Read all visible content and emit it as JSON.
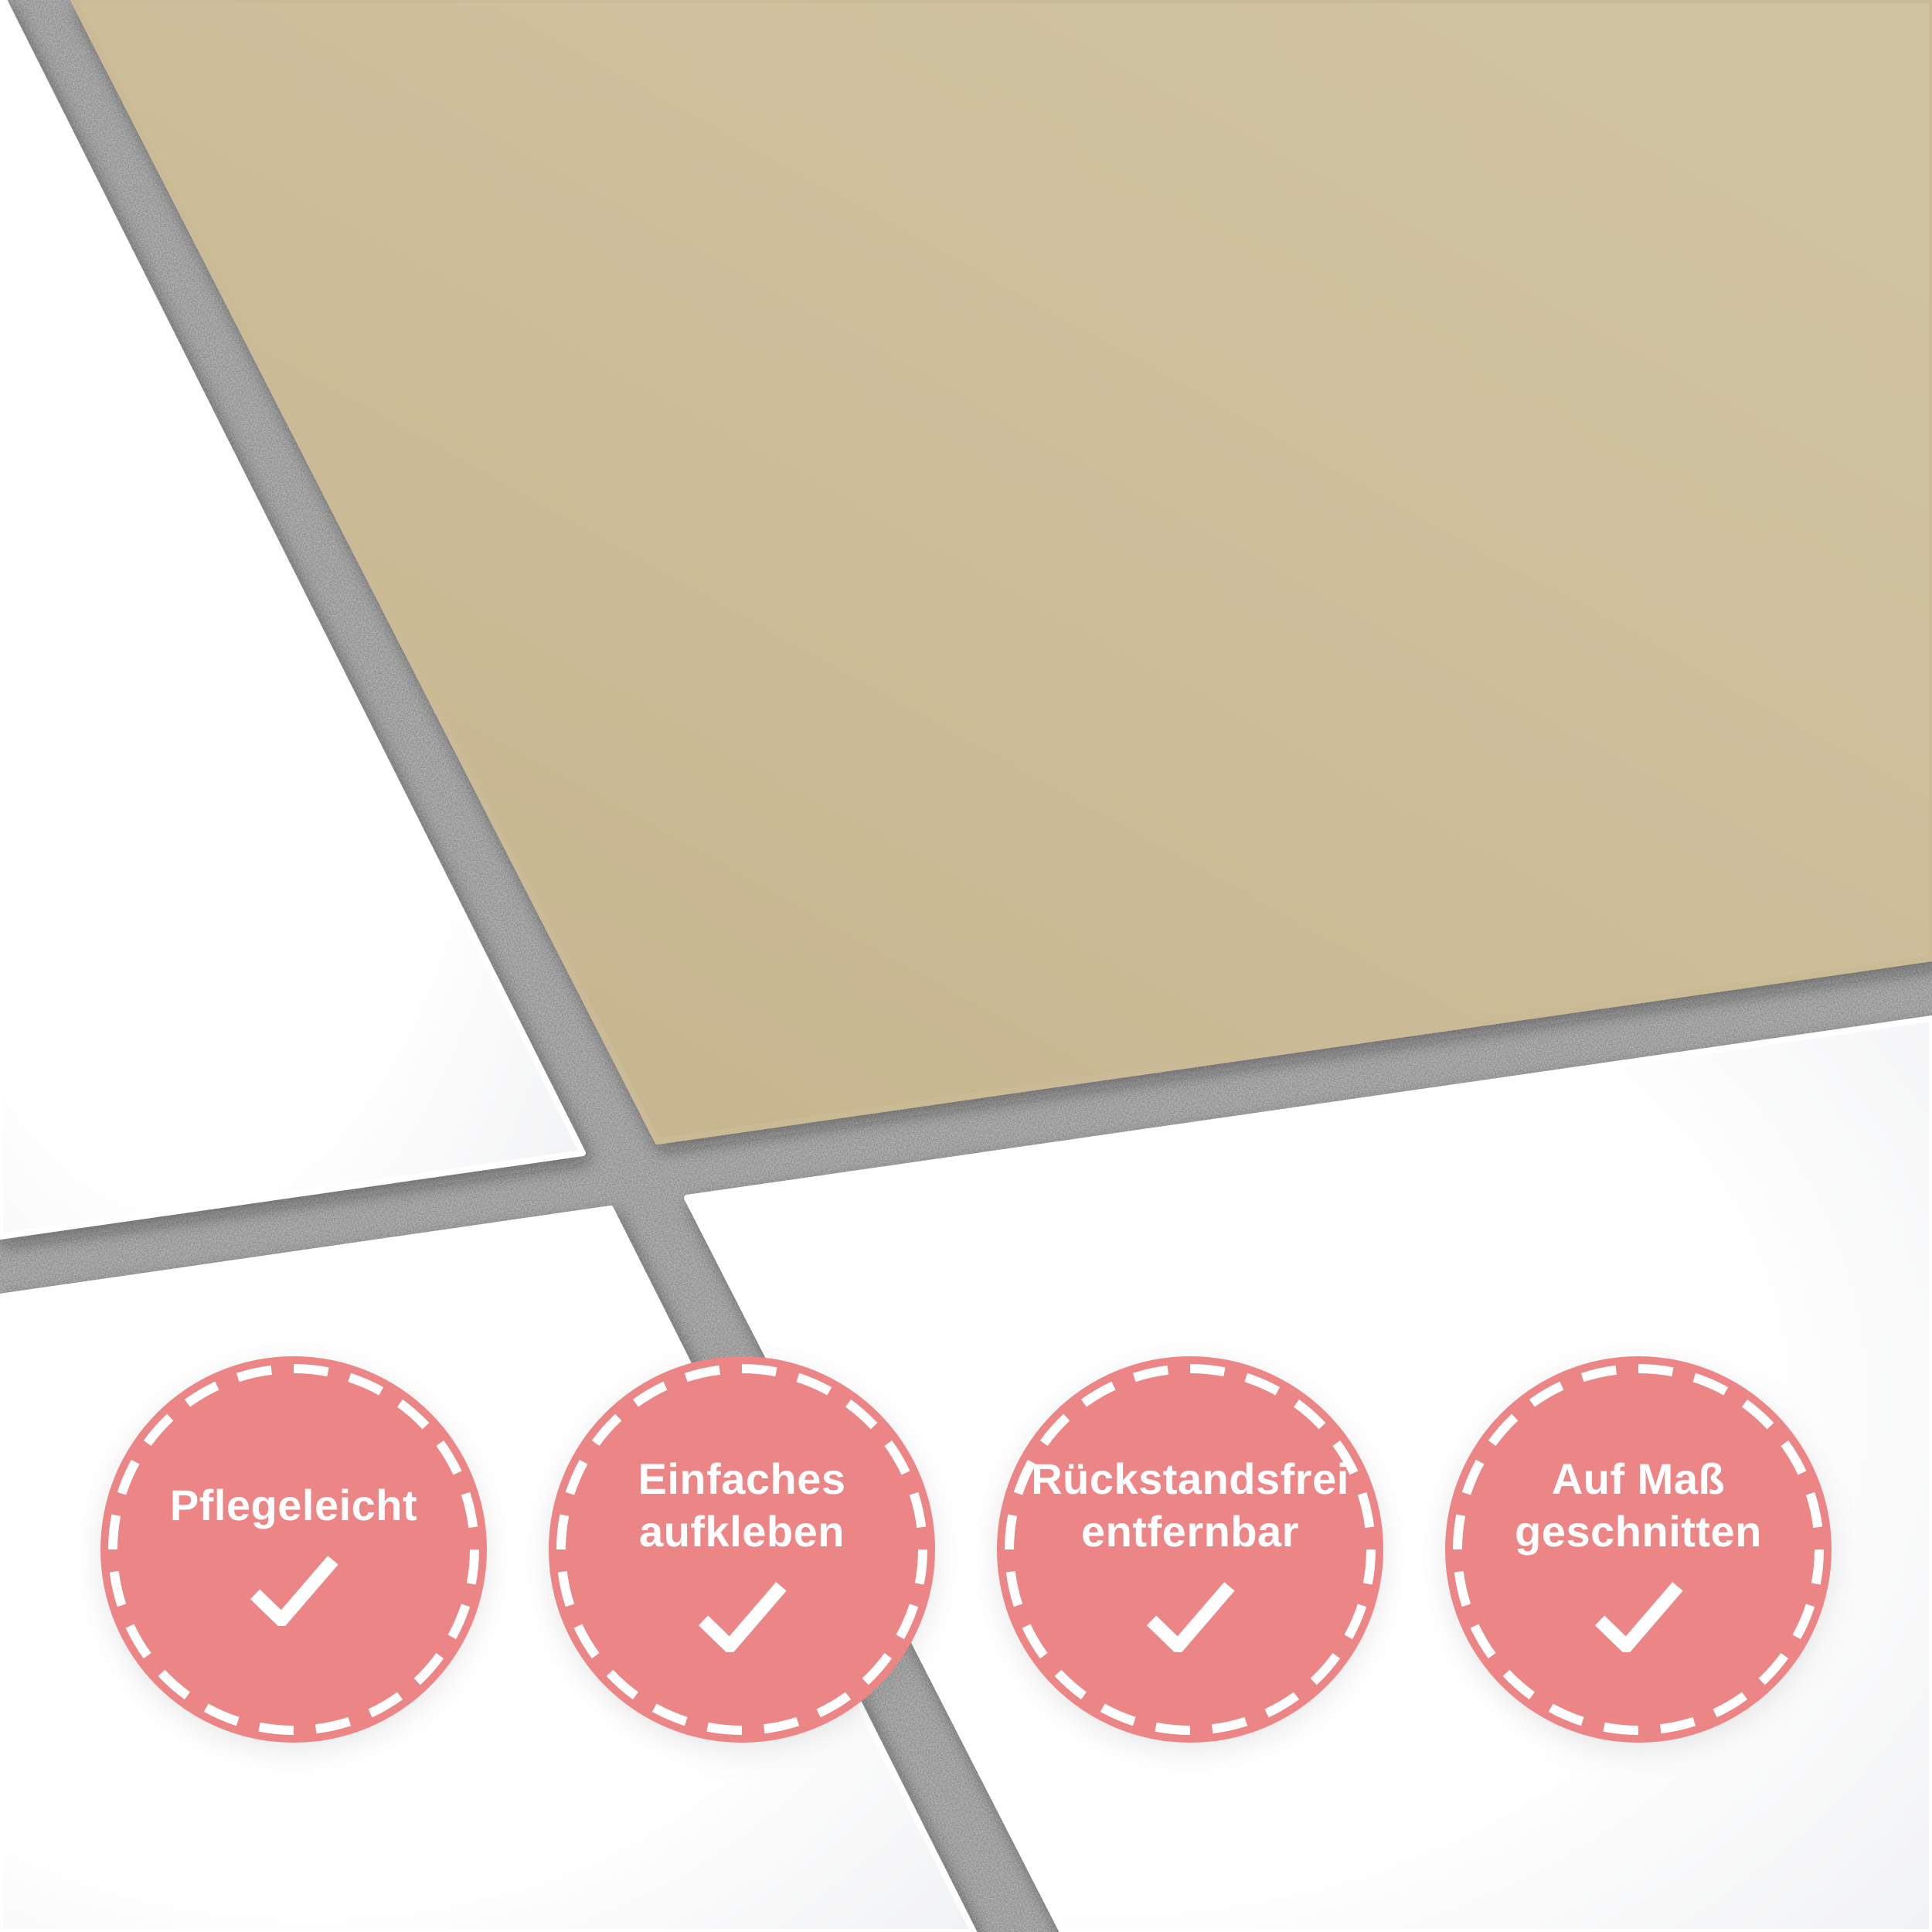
{
  "product_banner": {
    "badges": [
      {
        "line1": "Pflegeleicht",
        "line2": ""
      },
      {
        "line1": "Einfaches",
        "line2": "aufkleben"
      },
      {
        "line1": "Rückstandsfrei",
        "line2": "entfernbar"
      },
      {
        "line1": "Auf Maß",
        "line2": "geschnitten"
      }
    ],
    "check_icon": "checkmark",
    "colors": {
      "badge_pink": "#ec8585",
      "badge_border_dash": "#ffffff",
      "badge_text": "#ffffff",
      "tile_sticker_beige": "#cdc09b",
      "tile_white": "#ffffff",
      "grout_gray": "#868686"
    }
  }
}
